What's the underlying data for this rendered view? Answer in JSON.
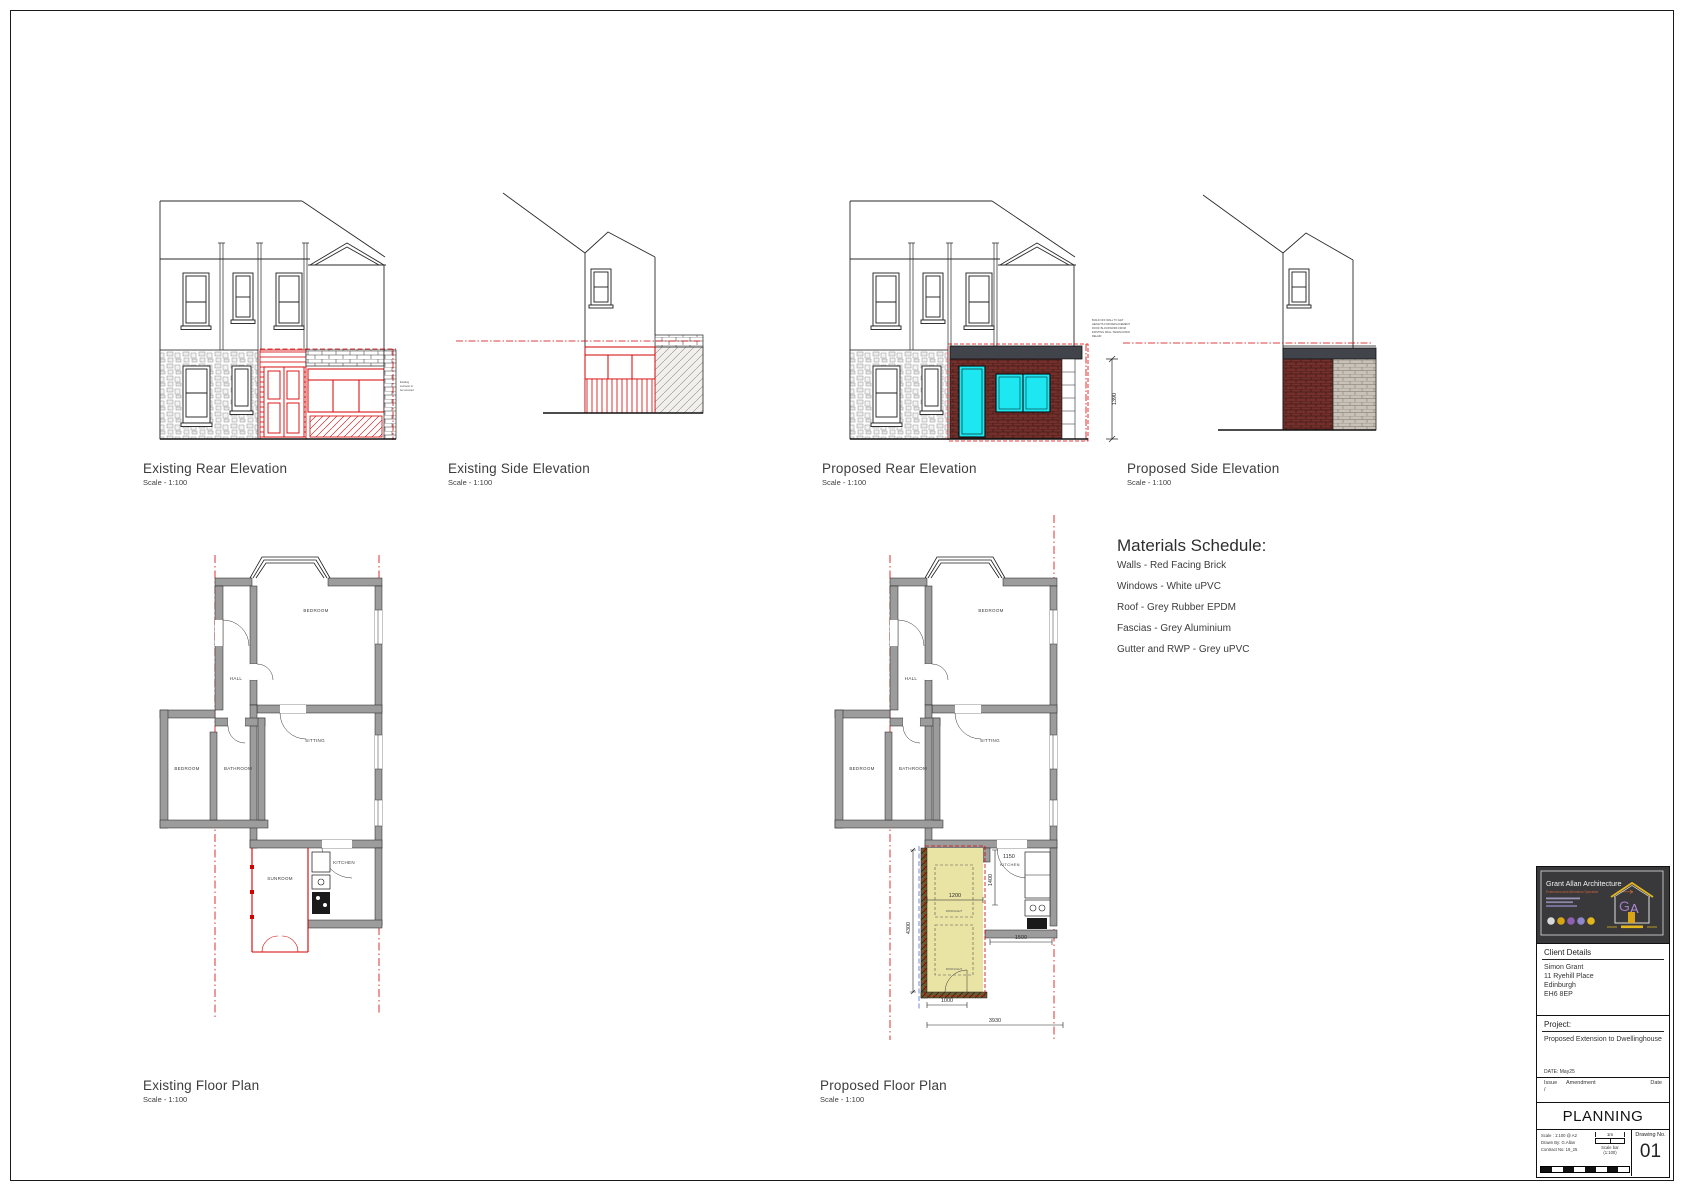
{
  "drawings": {
    "existing_rear_elevation": {
      "title": "Existing Rear Elevation",
      "scale": "Scale - 1:100",
      "note_lines": [
        "Existing",
        "sunroom to",
        "be removed"
      ]
    },
    "existing_side_elevation": {
      "title": "Existing Side Elevation",
      "scale": "Scale - 1:100"
    },
    "proposed_rear_elevation": {
      "title": "Proposed Rear Elevation",
      "scale": "Scale - 1:100",
      "dim_height": "1390",
      "note_lines": [
        "BUILD OFF WALL TO GET",
        "HEIGHTS FOR REPLACEMENT",
        "ROOF. BLOCKWORK FROM",
        "EXISTING WALL TAKEN DOWN",
        "RELAID"
      ]
    },
    "proposed_side_elevation": {
      "title": "Proposed Side Elevation",
      "scale": "Scale - 1:100"
    },
    "existing_floor_plan": {
      "title": "Existing Floor Plan",
      "scale": "Scale - 1:100",
      "rooms": {
        "bedroom_front": "BEDROOM",
        "hall": "HALL",
        "bedroom_rear": "BEDROOM",
        "bathroom": "BATHROOM",
        "sitting": "SITTING",
        "kitchen": "KITCHEN",
        "sunroom": "SUNROOM"
      }
    },
    "proposed_floor_plan": {
      "title": "Proposed Floor Plan",
      "scale": "Scale - 1:100",
      "rooms": {
        "bedroom_front": "BEDROOM",
        "hall": "HALL",
        "bedroom_rear": "BEDROOM",
        "bathroom": "BATHROOM",
        "sitting": "SITTING",
        "kitchen": "KITCHEN"
      },
      "dimensions": {
        "extension_length": "4300",
        "extension_width": "1200",
        "kitchen_recess": "1400",
        "kitchen_width": "1150",
        "rear_right": "1500",
        "rear_left": "1000",
        "overall_rear": "3930"
      },
      "annotations": {
        "rooflight_1": "ROOFLIGHT",
        "rooflight_2": "ROOFLIGHT"
      }
    }
  },
  "materials_schedule": {
    "title": "Materials Schedule:",
    "items": [
      "Walls - Red Facing Brick",
      "Windows - White uPVC",
      "Roof - Grey Rubber EPDM",
      "Fascias - Grey Aluminium",
      "Gutter and RWP - Grey uPVC"
    ]
  },
  "title_block": {
    "logo": {
      "company": "Grant Allan Architecture",
      "tagline": "Extensions and Alterations Specialist",
      "monogram_g": "G",
      "monogram_a": "A"
    },
    "client": {
      "heading": "Client Details",
      "lines": [
        "Simon Grant",
        "11 Ryehill Place",
        "Edinburgh",
        "EH6 8EP"
      ]
    },
    "project": {
      "heading": "Project:",
      "description": "Proposed Extension to Dwellinghouse",
      "date": "DATE: May25"
    },
    "issue": {
      "columns": [
        "Issue",
        "Amendment",
        "Date"
      ],
      "current": "/"
    },
    "status": "PLANNING",
    "info": {
      "scale": "Scale : 1:100 @ A2",
      "drawn_by": "Drawn By: G.Allan",
      "contract": "Contract No: 19_25"
    },
    "scale_bar": {
      "length_label": "1m",
      "caption_line1": "Scale bar",
      "caption_line2": "(1:100)"
    },
    "drawing_no": {
      "label": "Drawing No.",
      "value": "01"
    }
  },
  "colors": {
    "proposal_red": "#d40000",
    "highlight_yellow": "#e9e3a4",
    "window_cyan": "#1de8f2",
    "brick": "#76302b",
    "fascia": "#41444a",
    "wall_grey": "#9c9c9c"
  }
}
